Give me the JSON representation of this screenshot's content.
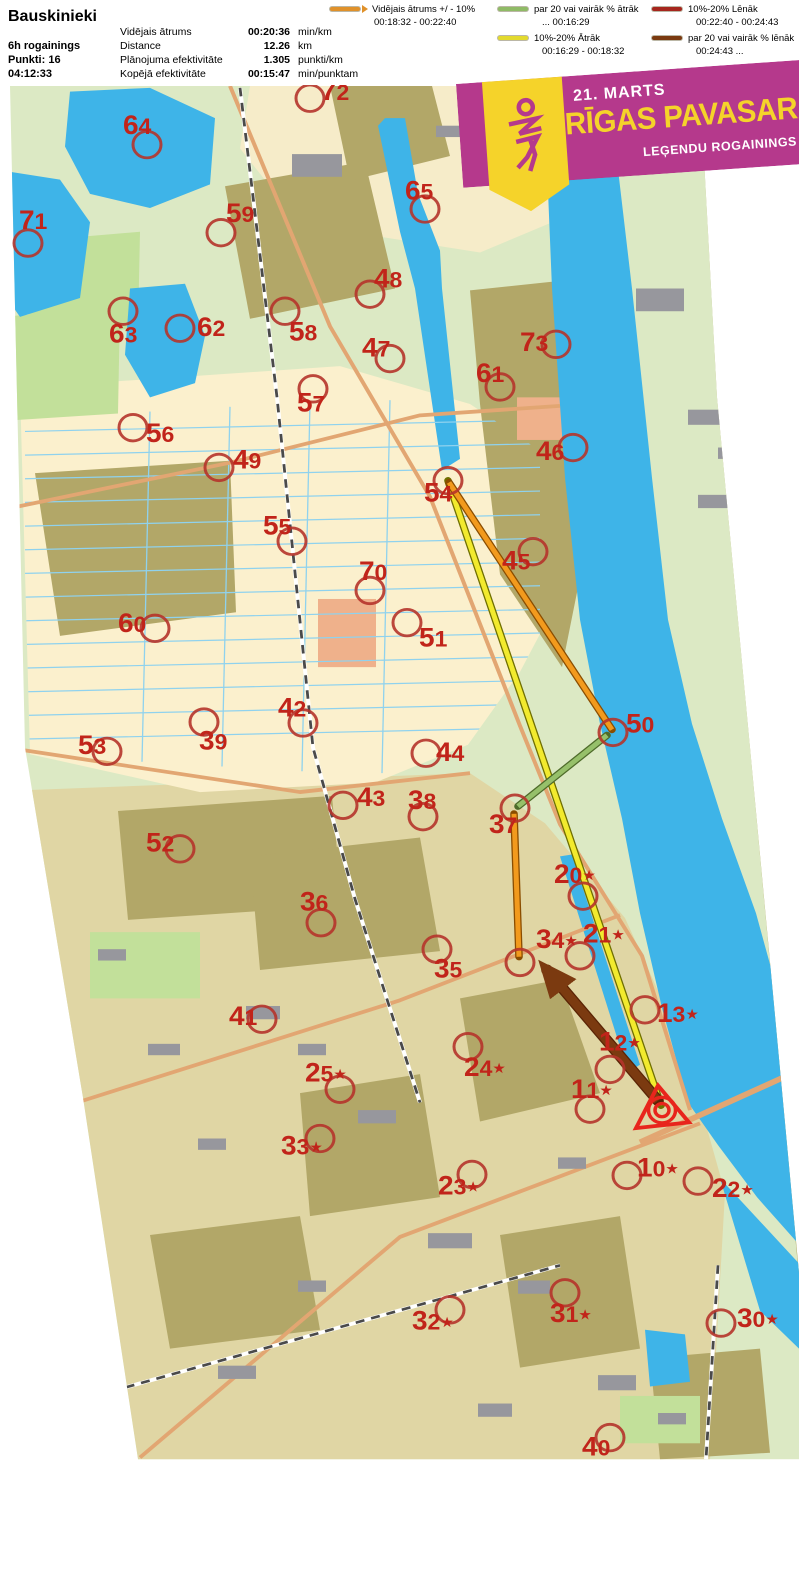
{
  "header": {
    "team": "Bauskinieki",
    "class": "6h rogainings",
    "points": "Punkti: 16",
    "time": "04:12:33",
    "stats": [
      {
        "label": "Vidējais ātrums",
        "value": "00:20:36",
        "unit": "min/km"
      },
      {
        "label": "Distance",
        "value": "12.26",
        "unit": "km"
      },
      {
        "label": "Plānojuma efektivitāte",
        "value": "1.305",
        "unit": "punkti/km"
      },
      {
        "label": "Kopējā efektivitāte",
        "value": "00:15:47",
        "unit": "min/punktam"
      }
    ]
  },
  "legend": {
    "items": [
      {
        "color": "#e0912a",
        "label": "Vidējais ātrums +/ - 10%",
        "range": "00:18:32   -   00:22:40",
        "arrow": true
      },
      {
        "color": "#8fbb66",
        "label": "par 20 vai vairāk % ātrāk",
        "range": "...    00:16:29"
      },
      {
        "color": "#e3da2e",
        "label": "10%-20% Ātrāk",
        "range": "00:16:29   -   00:18:32"
      },
      {
        "color": "#a6261d",
        "label": "10%-20% Lēnāk",
        "range": "00:22:40   -   00:24:43"
      },
      {
        "color": "#7b3a10",
        "label": "par 20 vai vairāk % lēnāk",
        "range": "00:24:43   ..."
      }
    ]
  },
  "banner": {
    "date": "21. MARTS",
    "title": "RĪGAS PAVASARA",
    "subtitle": "LEĢENDU ROGAININGS",
    "bg_color": "#b5398c",
    "accent_color": "#f5d32a"
  },
  "map": {
    "circle_color": "#b5342b",
    "label_color": "#c1241a",
    "start_finish": {
      "x": 662,
      "y": 1168,
      "color": "#e8251c"
    },
    "route": [
      {
        "name": "leg-yellow",
        "color": "#f2ea2e",
        "outline": "#6f6f00",
        "width": 5,
        "from": [
          448,
          503
        ],
        "to": [
          661,
          1163
        ]
      },
      {
        "name": "leg-orange-54-50",
        "color": "#f29a1d",
        "outline": "#8a4d00",
        "width": 5,
        "from": [
          449,
          505
        ],
        "to": [
          612,
          766
        ]
      },
      {
        "name": "leg-green-50-37",
        "color": "#96c06a",
        "outline": "#4e6b2a",
        "width": 5,
        "from": [
          607,
          772
        ],
        "to": [
          518,
          847
        ]
      },
      {
        "name": "leg-orange-37-34",
        "color": "#f29a1d",
        "outline": "#8a4d00",
        "width": 5,
        "from": [
          514,
          855
        ],
        "to": [
          519,
          1006
        ]
      },
      {
        "name": "leg-brown-arrow",
        "color": "#7b3a10",
        "outline": "#5a2405",
        "width": 9,
        "from": [
          658,
          1158
        ],
        "to": [
          547,
          1020
        ],
        "arrow": true
      }
    ],
    "controls": [
      {
        "n": "72",
        "cx": 310,
        "cy": 99,
        "lx": 321,
        "ly": 101
      },
      {
        "n": "64",
        "cx": 147,
        "cy": 148,
        "lx": 123,
        "ly": 137
      },
      {
        "n": "65",
        "cx": 425,
        "cy": 216,
        "lx": 405,
        "ly": 206
      },
      {
        "n": "71",
        "cx": 28,
        "cy": 252,
        "lx": 19,
        "ly": 237
      },
      {
        "n": "59",
        "cx": 221,
        "cy": 241,
        "lx": 226,
        "ly": 230
      },
      {
        "n": "48",
        "cx": 370,
        "cy": 306,
        "lx": 374,
        "ly": 299
      },
      {
        "n": "63",
        "cx": 123,
        "cy": 324,
        "lx": 109,
        "ly": 357
      },
      {
        "n": "62",
        "cx": 180,
        "cy": 342,
        "lx": 197,
        "ly": 350
      },
      {
        "n": "58",
        "cx": 285,
        "cy": 324,
        "lx": 289,
        "ly": 355
      },
      {
        "n": "47",
        "cx": 390,
        "cy": 374,
        "lx": 362,
        "ly": 372
      },
      {
        "n": "73",
        "cx": 556,
        "cy": 359,
        "lx": 520,
        "ly": 366
      },
      {
        "n": "61",
        "cx": 500,
        "cy": 404,
        "lx": 476,
        "ly": 399
      },
      {
        "n": "57",
        "cx": 313,
        "cy": 406,
        "lx": 297,
        "ly": 430
      },
      {
        "n": "56",
        "cx": 133,
        "cy": 447,
        "lx": 146,
        "ly": 462
      },
      {
        "n": "46",
        "cx": 573,
        "cy": 468,
        "lx": 536,
        "ly": 481
      },
      {
        "n": "49",
        "cx": 219,
        "cy": 489,
        "lx": 233,
        "ly": 490
      },
      {
        "n": "54",
        "cx": 448,
        "cy": 503,
        "lx": 424,
        "ly": 525
      },
      {
        "n": "55",
        "cx": 292,
        "cy": 567,
        "lx": 263,
        "ly": 560
      },
      {
        "n": "45",
        "cx": 533,
        "cy": 578,
        "lx": 502,
        "ly": 597
      },
      {
        "n": "70",
        "cx": 370,
        "cy": 619,
        "lx": 359,
        "ly": 608
      },
      {
        "n": "51",
        "cx": 407,
        "cy": 653,
        "lx": 419,
        "ly": 678
      },
      {
        "n": "60",
        "cx": 155,
        "cy": 659,
        "lx": 118,
        "ly": 663
      },
      {
        "n": "50",
        "cx": 613,
        "cy": 769,
        "lx": 626,
        "ly": 769
      },
      {
        "n": "42",
        "cx": 303,
        "cy": 759,
        "lx": 278,
        "ly": 752
      },
      {
        "n": "39",
        "cx": 204,
        "cy": 758,
        "lx": 199,
        "ly": 787
      },
      {
        "n": "53",
        "cx": 107,
        "cy": 789,
        "lx": 78,
        "ly": 792
      },
      {
        "n": "44",
        "cx": 426,
        "cy": 791,
        "lx": 436,
        "ly": 799
      },
      {
        "n": "43",
        "cx": 343,
        "cy": 846,
        "lx": 357,
        "ly": 847
      },
      {
        "n": "38",
        "cx": 423,
        "cy": 858,
        "lx": 408,
        "ly": 850
      },
      {
        "n": "37",
        "cx": 515,
        "cy": 849,
        "lx": 489,
        "ly": 875
      },
      {
        "n": "52",
        "cx": 180,
        "cy": 892,
        "lx": 146,
        "ly": 895
      },
      {
        "n": "20*",
        "cx": 583,
        "cy": 942,
        "lx": 554,
        "ly": 928
      },
      {
        "n": "36",
        "cx": 321,
        "cy": 970,
        "lx": 300,
        "ly": 957
      },
      {
        "n": "21*",
        "cx": 580,
        "cy": 1005,
        "lx": 583,
        "ly": 991
      },
      {
        "n": "34*",
        "cx": 520,
        "cy": 1012,
        "lx": 536,
        "ly": 997
      },
      {
        "n": "35",
        "cx": 437,
        "cy": 998,
        "lx": 434,
        "ly": 1028
      },
      {
        "n": "13*",
        "cx": 645,
        "cy": 1062,
        "lx": 657,
        "ly": 1075
      },
      {
        "n": "41",
        "cx": 262,
        "cy": 1072,
        "lx": 229,
        "ly": 1078
      },
      {
        "n": "12*",
        "cx": 610,
        "cy": 1125,
        "lx": 599,
        "ly": 1105
      },
      {
        "n": "24*",
        "cx": 468,
        "cy": 1101,
        "lx": 464,
        "ly": 1132
      },
      {
        "n": "25*",
        "cx": 340,
        "cy": 1146,
        "lx": 305,
        "ly": 1138
      },
      {
        "n": "11*",
        "cx": 590,
        "cy": 1167,
        "lx": 571,
        "ly": 1155
      },
      {
        "n": "33*",
        "cx": 320,
        "cy": 1198,
        "lx": 281,
        "ly": 1215
      },
      {
        "n": "23*",
        "cx": 472,
        "cy": 1236,
        "lx": 438,
        "ly": 1257
      },
      {
        "n": "10*",
        "cx": 627,
        "cy": 1237,
        "lx": 637,
        "ly": 1238
      },
      {
        "n": "22*",
        "cx": 698,
        "cy": 1243,
        "lx": 712,
        "ly": 1260
      },
      {
        "n": "32*",
        "cx": 450,
        "cy": 1379,
        "lx": 412,
        "ly": 1400
      },
      {
        "n": "31*",
        "cx": 565,
        "cy": 1361,
        "lx": 550,
        "ly": 1392
      },
      {
        "n": "30*",
        "cx": 721,
        "cy": 1393,
        "lx": 737,
        "ly": 1397
      },
      {
        "n": "40",
        "cx": 610,
        "cy": 1514,
        "lx": 582,
        "ly": 1533
      }
    ]
  }
}
